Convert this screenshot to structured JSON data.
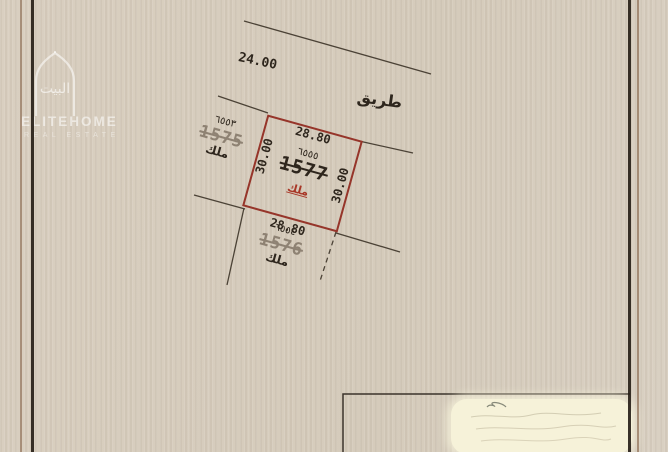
{
  "colors": {
    "paper": "#d7cdbe",
    "plot_outline": "#96352a",
    "ownership_red": "#a83727",
    "ink": "#2e261d",
    "faded_ink": "#8e8273",
    "frame_dark": "#241c14",
    "frame_brown": "#8f6f56",
    "redaction": "#f6f2d9",
    "line": "#4b4236"
  },
  "road": {
    "width_dim": "24.00",
    "name": "طريق"
  },
  "plot": {
    "parcel_number": "1577",
    "survey_number": "٦٥٥٥",
    "ownership": "ملك",
    "dim_top": "28.80",
    "dim_bottom": "28.80",
    "dim_left": "30.00",
    "dim_right": "30.00"
  },
  "neighbors": {
    "left": {
      "survey_number": "٦٥٥٣",
      "parcel_number": "1575",
      "ownership": "ملك"
    },
    "bottom": {
      "survey_number": "٦٥٥٤",
      "parcel_number": "1576",
      "ownership": "ملك"
    },
    "right": {
      "parcel_number": "1579"
    }
  },
  "watermark": {
    "arabic_logo": "البيت",
    "brand": "ELITEHOME",
    "tagline": "REAL ESTATE"
  }
}
